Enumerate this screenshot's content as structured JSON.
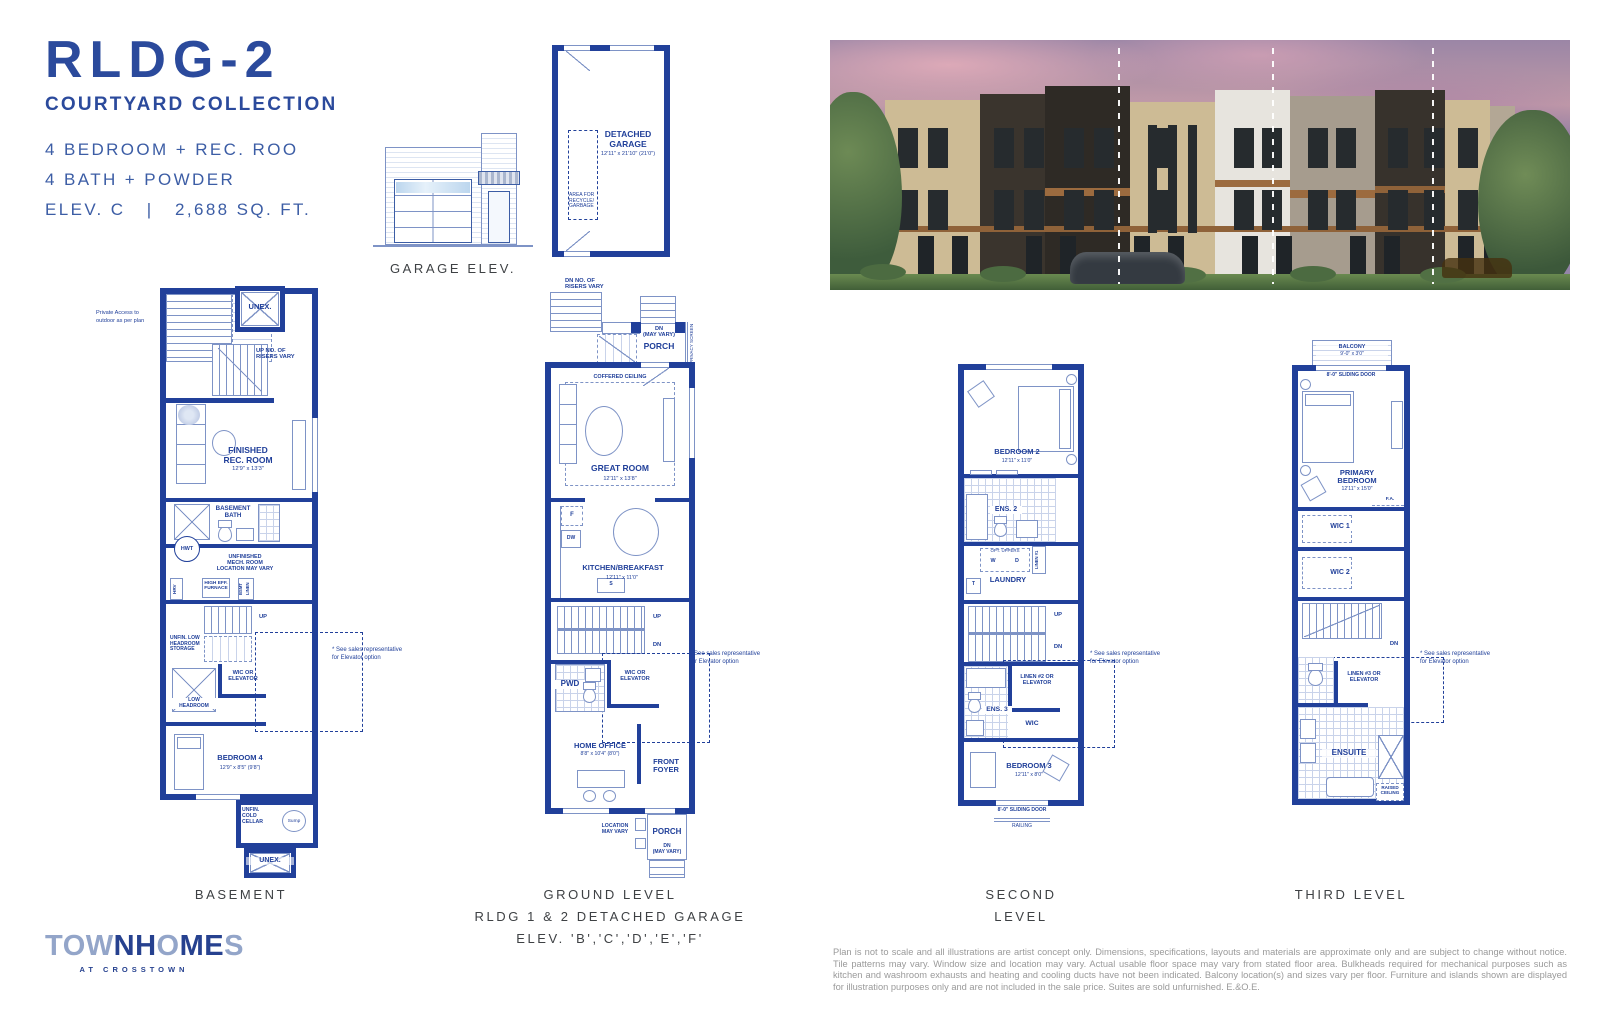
{
  "header": {
    "title": "RLDG-2",
    "collection": "COURTYARD COLLECTION",
    "spec1": "4 BEDROOM + REC. ROO",
    "spec2": "4 BATH + POWDER",
    "spec3": "ELEV. C   |   2,688 SQ. FT."
  },
  "garage": {
    "caption": "GARAGE ELEV.",
    "plan_name": "DETACHED\nGARAGE",
    "plan_dims": "12'11\" x 21'10\" (21'0\")",
    "recycle": "AREA FOR\nRECYCLE/\nGARBAGE"
  },
  "plans": {
    "basement": {
      "caption": "BASEMENT",
      "labels": {
        "unex_top": "UNEX.",
        "unex_bottom": "UNEX.",
        "private": "Private Access to\noutdoor as per plan",
        "up_risers": "UP NO. OF\nRISERS VARY",
        "rec": "FINISHED\nREC. ROOM",
        "rec_dims": "12'9\" x 13'3\"",
        "bath": "BASEMENT\nBATH",
        "hwt": "HWT",
        "mech": "UNFINISHED\nMECH. ROOM\nLOCATION MAY VARY",
        "hrv": "HRV",
        "furnace": "HIGH EFF.\nFURNACE",
        "bsmt": "BSMT",
        "linen": "LINEN",
        "up": "UP",
        "storage": "UNFIN. LOW\nHEADROOM\nSTORAGE",
        "wic_elev": "WIC OR\nELEVATOR",
        "low_head": "LOW\nHEADROOM",
        "bed4": "BEDROOM 4",
        "bed4_dims": "12'9\" x 8'5\" (9'8\")",
        "cold": "UNFIN.\nCOLD\nCELLAR",
        "sump": "Sump",
        "elev_note": "* See sales representative\nfor Elevator option"
      }
    },
    "ground": {
      "caption": "GROUND LEVEL\nRLDG 1 & 2 DETACHED GARAGE\nELEV. 'B','C','D','E','F'",
      "labels": {
        "dn_risers": "DN NO. OF\nRISERS VARY",
        "dn_vary_top": "DN\n(MAY VARY)",
        "porch_top": "PORCH",
        "privacy": "PRIVACY SCREEN",
        "coffered": "COFFERED CEILING",
        "great": "GREAT ROOM",
        "great_dims": "12'11\" x 13'8\"",
        "fridge": "F",
        "dw": "DW",
        "sink": "S",
        "kitchen": "KITCHEN/BREAKFAST",
        "kitchen_dims": "12'11\" x 11'0\"",
        "up": "UP",
        "dn": "DN",
        "wic_elev": "WIC OR\nELEVATOR",
        "pwd": "PWD",
        "office": "HOME OFFICE",
        "office_dims": "8'8\" x 10'4\" (8'0\")",
        "foyer": "FRONT\nFOYER",
        "location": "LOCATION\nMAY VARY",
        "porch_bottom": "PORCH",
        "dn_vary_bottom": "DN\n(MAY VARY)",
        "elev_note": "* See sales representative\nfor Elevator option"
      }
    },
    "second": {
      "caption": "SECOND LEVEL",
      "labels": {
        "bed2": "BEDROOM 2",
        "bed2_dims": "12'11\" x 11'0\"",
        "ens2": "ENS. 2",
        "opt_uppers": "OPT. UPPERS",
        "washer": "W",
        "dryer": "D",
        "linen1": "LINEN #1",
        "laundry": "LAUNDRY",
        "tub": "T",
        "up": "UP",
        "dn": "DN",
        "linen2": "LINEN #2 OR\nELEVATOR",
        "ens3": "ENS. 3",
        "wic": "WIC",
        "bed3": "BEDROOM 3",
        "bed3_dims": "12'11\" x 8'0\"",
        "sliding": "8'-0\" SLIDING DOOR",
        "railing": "RAILING",
        "elev_note": "* See sales representative\nfor Elevator option"
      }
    },
    "third": {
      "caption": "THIRD LEVEL",
      "labels": {
        "balcony": "BALCONY",
        "balcony_dims": "9'-0\" x 3'0\"",
        "sliding": "8'-0\" SLIDING DOOR",
        "primary": "PRIMARY\nBEDROOM",
        "primary_dims": "12'11\" x 15'0\"",
        "fa": "F.A.",
        "wic1": "WIC 1",
        "wic2": "WIC 2",
        "dn": "DN",
        "linen3": "LINEN #3 OR\nELEVATOR",
        "ensuite": "ENSUITE",
        "raised": "RAISED\nCEILING",
        "elev_note": "* See sales representative\nfor Elevator option"
      }
    }
  },
  "footer": {
    "logo": {
      "word": "TOWNHOMES",
      "letters": [
        {
          "ch": "T",
          "tone": "l"
        },
        {
          "ch": "O",
          "tone": "l"
        },
        {
          "ch": "W",
          "tone": "l"
        },
        {
          "ch": "N",
          "tone": "d"
        },
        {
          "ch": "H",
          "tone": "d"
        },
        {
          "ch": "O",
          "tone": "l"
        },
        {
          "ch": "M",
          "tone": "d"
        },
        {
          "ch": "E",
          "tone": "d"
        },
        {
          "ch": "S",
          "tone": "l"
        }
      ],
      "dark": "#26418f",
      "light": "#93a5c9",
      "tagline": "AT CROSSTOWN"
    },
    "disclaimer": "Plan is not to scale and all illustrations are artist concept only. Dimensions, specifications, layouts and materials are approximate only and are subject to change without notice. Tile patterns may vary. Window size and location may vary. Actual usable floor space may vary from stated floor area. Bulkheads required for mechanical purposes such as kitchen and washroom exhausts and heating and cooling ducts have not been indicated. Balcony location(s) and sizes vary per floor. Furniture and islands shown are displayed for illustration purposes only and are not included in the sale price. Suites are sold unfurnished. E.&O.E."
  },
  "colors": {
    "wall_navy": "#21409a",
    "line_light": "#7e93c6",
    "title_blue": "#2b4a9c",
    "caption_ink": "#3e4144",
    "disclaimer_grey": "#9a9a9a"
  }
}
